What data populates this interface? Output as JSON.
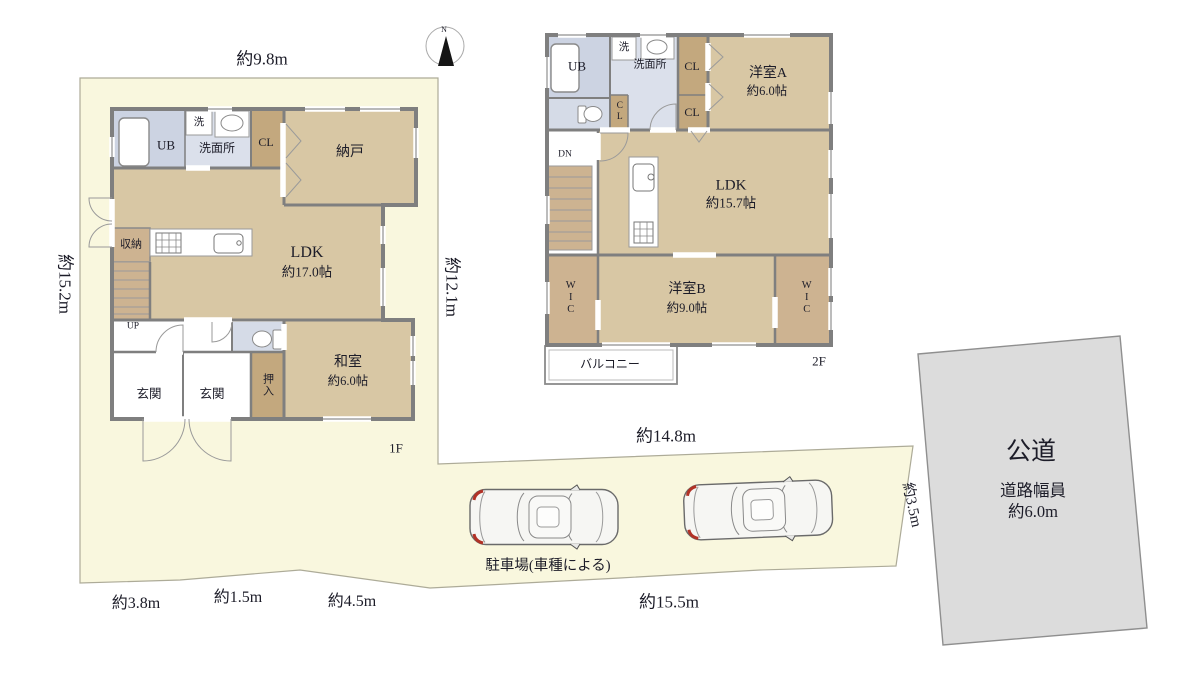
{
  "compass": {
    "north": "N"
  },
  "site": {
    "dim_top": "約9.8m",
    "dim_left": "約15.2m",
    "dim_right_1f": "約12.1m",
    "dim_mid": "約14.8m",
    "dim_road_side": "約3.5m",
    "dim_bottom_1": "約3.8m",
    "dim_bottom_2": "約1.5m",
    "dim_bottom_3": "約4.5m",
    "dim_bottom_4": "約15.5m",
    "parking_label": "駐車場(車種による)",
    "road_name": "公道",
    "road_width_title": "道路幅員",
    "road_width_value": "約6.0m"
  },
  "floor1": {
    "label": "1F",
    "ub": "UB",
    "laundry": "洗",
    "washroom": "洗面所",
    "closet_cl": "CL",
    "storage_room": "納戸",
    "storage": "収納",
    "up": "UP",
    "ldk_name": "LDK",
    "ldk_size": "約17.0帖",
    "entrance_1": "玄関",
    "entrance_2": "玄関",
    "oshiire": "押入",
    "washitsu_name": "和室",
    "washitsu_size": "約6.0帖"
  },
  "floor2": {
    "label": "2F",
    "ub": "UB",
    "laundry": "洗",
    "washroom": "洗面所",
    "closet_hall": "CL",
    "closet_a1": "CL",
    "closet_a2": "CL",
    "dn": "DN",
    "ldk_name": "LDK",
    "ldk_size": "約15.7帖",
    "room_a_name": "洋室A",
    "room_a_size": "約6.0帖",
    "room_b_name": "洋室B",
    "room_b_size": "約9.0帖",
    "wic_left": "WIC",
    "wic_right": "WIC",
    "balcony": "バルコニー"
  },
  "colors": {
    "site_fill": "#f9f7de",
    "room_tan": "#d8c7a4",
    "closet_tan": "#c3a87e",
    "stairs_tan": "#cdb391",
    "bath_blue": "#ccd3e2",
    "washroom_blue": "#dbe0eb",
    "toilet_blue": "#d5dbe7",
    "wall_gray": "#7f7f7f",
    "road_gray": "#dcdcdc",
    "car_red": "#b23226"
  }
}
